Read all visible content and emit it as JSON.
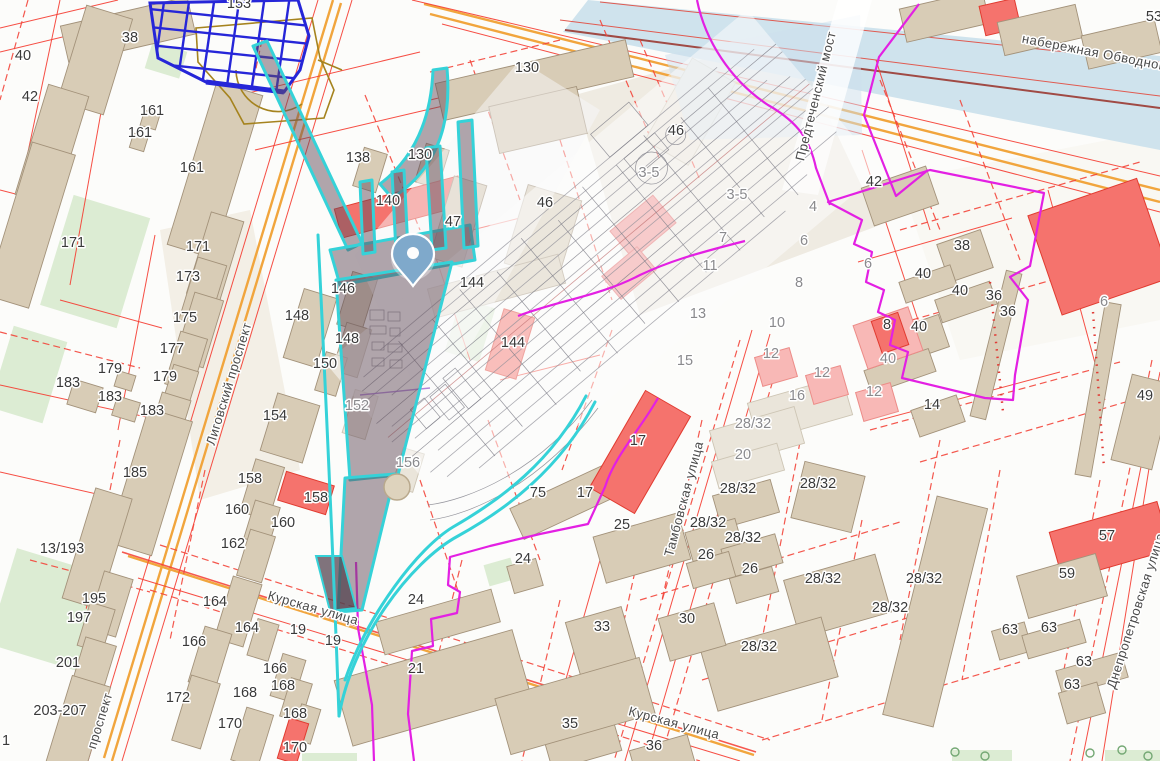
{
  "app": {
    "name": "cadastral-map-viewer",
    "view": "city-block-map"
  },
  "colors": {
    "water": "#cfe3ed",
    "building": "#d8ccb6",
    "building_red": "#f5736d",
    "building_pink": "#f8b8b6",
    "parcel_line_red": "#f53b30",
    "zone_boundary_magenta": "#e320e3",
    "selection_cyan": "#35d2d8",
    "road_orange": "#f1a53d",
    "hatch_blue": "#2626d8",
    "pin_blue": "#7fa9cb"
  },
  "streets": [
    {
      "text": "Лиговский проспект",
      "x": 233,
      "y": 385,
      "r": -73
    },
    {
      "text": "проспект",
      "x": 104,
      "y": 722,
      "r": -73
    },
    {
      "text": "Курская улица",
      "x": 312,
      "y": 612,
      "r": 16
    },
    {
      "text": "Курская улица",
      "x": 673,
      "y": 727,
      "r": 15
    },
    {
      "text": "Тамбовская улица",
      "x": 688,
      "y": 500,
      "r": -75
    },
    {
      "text": "набережная Обводного",
      "x": 1096,
      "y": 57,
      "r": 11
    },
    {
      "text": "Предтеченский мост",
      "x": 820,
      "y": 97,
      "r": -76
    },
    {
      "text": "Днепропетровская улица",
      "x": 1140,
      "y": 612,
      "r": -72
    }
  ],
  "house_numbers": [
    {
      "t": "153",
      "x": 239,
      "y": 8
    },
    {
      "t": "38",
      "x": 130,
      "y": 42
    },
    {
      "t": "40",
      "x": 23,
      "y": 60
    },
    {
      "t": "42",
      "x": 30,
      "y": 101
    },
    {
      "t": "161",
      "x": 152,
      "y": 115
    },
    {
      "t": "161",
      "x": 140,
      "y": 137
    },
    {
      "t": "161",
      "x": 192,
      "y": 172
    },
    {
      "t": "171",
      "x": 73,
      "y": 247
    },
    {
      "t": "171",
      "x": 198,
      "y": 251
    },
    {
      "t": "173",
      "x": 188,
      "y": 281
    },
    {
      "t": "175",
      "x": 185,
      "y": 322
    },
    {
      "t": "177",
      "x": 172,
      "y": 353
    },
    {
      "t": "179",
      "x": 110,
      "y": 373
    },
    {
      "t": "179",
      "x": 165,
      "y": 381
    },
    {
      "t": "183",
      "x": 68,
      "y": 387
    },
    {
      "t": "183",
      "x": 110,
      "y": 401
    },
    {
      "t": "183",
      "x": 152,
      "y": 415
    },
    {
      "t": "185",
      "x": 135,
      "y": 477
    },
    {
      "t": "13/193",
      "x": 62,
      "y": 553
    },
    {
      "t": "195",
      "x": 94,
      "y": 603
    },
    {
      "t": "197",
      "x": 79,
      "y": 622
    },
    {
      "t": "201",
      "x": 68,
      "y": 667
    },
    {
      "t": "203-207",
      "x": 60,
      "y": 715
    },
    {
      "t": "1",
      "x": 6,
      "y": 745
    },
    {
      "t": "154",
      "x": 275,
      "y": 420
    },
    {
      "t": "158",
      "x": 250,
      "y": 483
    },
    {
      "t": "158",
      "x": 316,
      "y": 502
    },
    {
      "t": "160",
      "x": 237,
      "y": 514
    },
    {
      "t": "160",
      "x": 283,
      "y": 527
    },
    {
      "t": "162",
      "x": 233,
      "y": 548
    },
    {
      "t": "164",
      "x": 215,
      "y": 606
    },
    {
      "t": "164",
      "x": 247,
      "y": 632
    },
    {
      "t": "166",
      "x": 194,
      "y": 646
    },
    {
      "t": "166",
      "x": 275,
      "y": 673
    },
    {
      "t": "168",
      "x": 283,
      "y": 690
    },
    {
      "t": "168",
      "x": 245,
      "y": 697
    },
    {
      "t": "168",
      "x": 295,
      "y": 718
    },
    {
      "t": "170",
      "x": 230,
      "y": 728
    },
    {
      "t": "170",
      "x": 295,
      "y": 752
    },
    {
      "t": "172",
      "x": 178,
      "y": 702
    },
    {
      "t": "19",
      "x": 298,
      "y": 634
    },
    {
      "t": "19",
      "x": 333,
      "y": 645
    },
    {
      "t": "138",
      "x": 358,
      "y": 162
    },
    {
      "t": "130",
      "x": 420,
      "y": 159
    },
    {
      "t": "140",
      "x": 388,
      "y": 205
    },
    {
      "t": "47",
      "x": 453,
      "y": 226
    },
    {
      "t": "146",
      "x": 343,
      "y": 293
    },
    {
      "t": "148",
      "x": 297,
      "y": 320
    },
    {
      "t": "148",
      "x": 347,
      "y": 343
    },
    {
      "t": "150",
      "x": 325,
      "y": 368
    },
    {
      "t": "152",
      "x": 357,
      "y": 410,
      "g": 1
    },
    {
      "t": "156",
      "x": 408,
      "y": 467,
      "g": 1
    },
    {
      "t": "130",
      "x": 527,
      "y": 72
    },
    {
      "t": "46",
      "x": 545,
      "y": 207
    },
    {
      "t": "144",
      "x": 472,
      "y": 287
    },
    {
      "t": "144",
      "x": 513,
      "y": 347
    },
    {
      "t": "46",
      "x": 676,
      "y": 135
    },
    {
      "t": "3-5",
      "x": 649,
      "y": 177,
      "g": 1
    },
    {
      "t": "3-5",
      "x": 737,
      "y": 199,
      "g": 1
    },
    {
      "t": "7",
      "x": 723,
      "y": 242,
      "g": 1
    },
    {
      "t": "11",
      "x": 710,
      "y": 270,
      "g": 1
    },
    {
      "t": "13",
      "x": 698,
      "y": 318,
      "g": 1
    },
    {
      "t": "15",
      "x": 685,
      "y": 365,
      "g": 1
    },
    {
      "t": "4",
      "x": 813,
      "y": 211,
      "g": 1
    },
    {
      "t": "6",
      "x": 804,
      "y": 245,
      "g": 1
    },
    {
      "t": "6",
      "x": 868,
      "y": 268,
      "g": 1
    },
    {
      "t": "8",
      "x": 799,
      "y": 287,
      "g": 1
    },
    {
      "t": "10",
      "x": 777,
      "y": 327,
      "g": 1
    },
    {
      "t": "12",
      "x": 771,
      "y": 358,
      "g": 1
    },
    {
      "t": "12",
      "x": 822,
      "y": 377,
      "g": 1
    },
    {
      "t": "12",
      "x": 874,
      "y": 396,
      "g": 1
    },
    {
      "t": "16",
      "x": 797,
      "y": 400,
      "g": 1
    },
    {
      "t": "28/32",
      "x": 753,
      "y": 428,
      "g": 1
    },
    {
      "t": "20",
      "x": 743,
      "y": 459,
      "g": 1
    },
    {
      "t": "75",
      "x": 538,
      "y": 497
    },
    {
      "t": "17",
      "x": 585,
      "y": 497
    },
    {
      "t": "17",
      "x": 638,
      "y": 445
    },
    {
      "t": "25",
      "x": 622,
      "y": 529
    },
    {
      "t": "24",
      "x": 523,
      "y": 563
    },
    {
      "t": "24",
      "x": 416,
      "y": 604
    },
    {
      "t": "21",
      "x": 416,
      "y": 673
    },
    {
      "t": "33",
      "x": 602,
      "y": 631
    },
    {
      "t": "30",
      "x": 687,
      "y": 623
    },
    {
      "t": "35",
      "x": 570,
      "y": 728
    },
    {
      "t": "36",
      "x": 654,
      "y": 750
    },
    {
      "t": "26",
      "x": 706,
      "y": 559
    },
    {
      "t": "26",
      "x": 750,
      "y": 573
    },
    {
      "t": "28/32",
      "x": 738,
      "y": 493
    },
    {
      "t": "28/32",
      "x": 708,
      "y": 527
    },
    {
      "t": "28/32",
      "x": 743,
      "y": 542
    },
    {
      "t": "28/32",
      "x": 818,
      "y": 488
    },
    {
      "t": "28/32",
      "x": 823,
      "y": 583
    },
    {
      "t": "28/32",
      "x": 890,
      "y": 612
    },
    {
      "t": "28/32",
      "x": 759,
      "y": 651
    },
    {
      "t": "28/32",
      "x": 924,
      "y": 583
    },
    {
      "t": "42",
      "x": 874,
      "y": 186
    },
    {
      "t": "38",
      "x": 962,
      "y": 250
    },
    {
      "t": "40",
      "x": 923,
      "y": 278
    },
    {
      "t": "40",
      "x": 960,
      "y": 295
    },
    {
      "t": "40",
      "x": 919,
      "y": 331
    },
    {
      "t": "40",
      "x": 888,
      "y": 363,
      "g": 1
    },
    {
      "t": "36",
      "x": 994,
      "y": 300
    },
    {
      "t": "36",
      "x": 1008,
      "y": 316
    },
    {
      "t": "8",
      "x": 887,
      "y": 329
    },
    {
      "t": "14",
      "x": 932,
      "y": 409
    },
    {
      "t": "6",
      "x": 1104,
      "y": 306,
      "g": 1
    },
    {
      "t": "49",
      "x": 1145,
      "y": 400
    },
    {
      "t": "53",
      "x": 1154,
      "y": 21
    },
    {
      "t": "57",
      "x": 1107,
      "y": 540
    },
    {
      "t": "59",
      "x": 1067,
      "y": 578
    },
    {
      "t": "63",
      "x": 1010,
      "y": 634
    },
    {
      "t": "63",
      "x": 1049,
      "y": 632
    },
    {
      "t": "63",
      "x": 1084,
      "y": 666
    },
    {
      "t": "63",
      "x": 1072,
      "y": 689
    }
  ],
  "marker": {
    "type": "location-pin"
  }
}
